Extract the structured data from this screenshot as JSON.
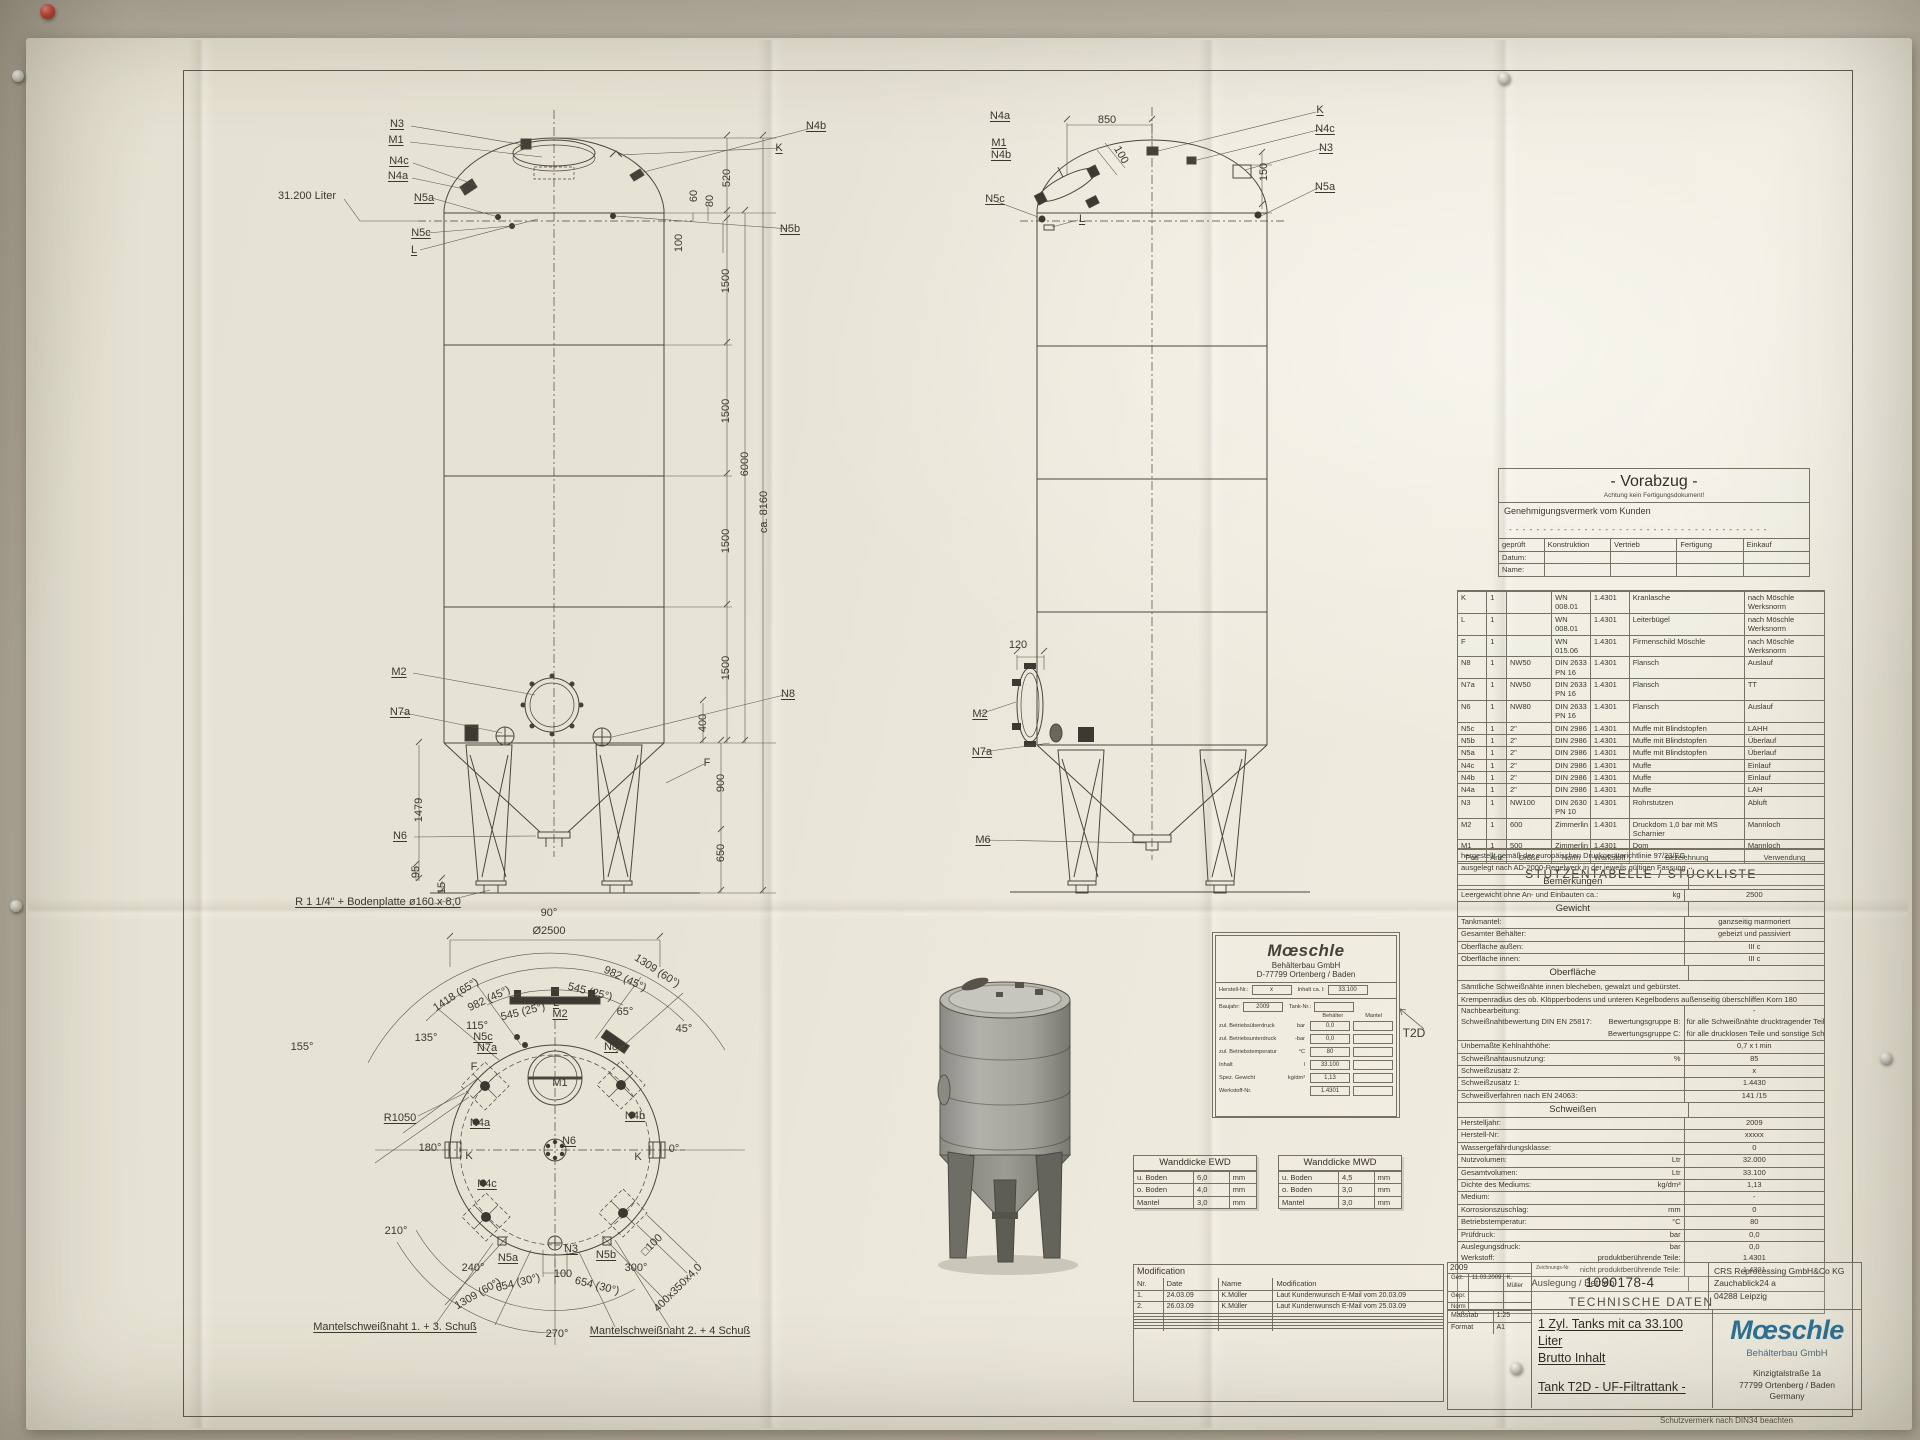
{
  "vorabzug": {
    "title": "- Vorabzug -",
    "subtitle": "Achtung kein Fertigungsdokument!",
    "approval": "Genehmigungsvermerk vom Kunden",
    "dashes": "- - - - - - - - - - - - - - - - - - - - - - - - - - - - - - - - - - - - - -",
    "headers": [
      "geprüft",
      "Konstruktion",
      "Vertrieb",
      "Fertigung",
      "Einkauf"
    ],
    "rows": [
      [
        "Datum:",
        "",
        "",
        "",
        ""
      ],
      [
        "Name:",
        "",
        "",
        "",
        ""
      ]
    ]
  },
  "stueckliste": {
    "title": "STUTZENTABELLE / STÜCKLISTE",
    "headers": [
      "Pos",
      "Anz",
      "Größe",
      "Norm",
      "Werkstoff",
      "Bezeichnung",
      "Verwendung"
    ],
    "rows": [
      [
        "K",
        "1",
        "",
        "WN 008.01",
        "1.4301",
        "Kranlasche",
        "nach Möschle Werksnorm"
      ],
      [
        "L",
        "1",
        "",
        "WN 008.01",
        "1.4301",
        "Leiterbügel",
        "nach Möschle Werksnorm"
      ],
      [
        "F",
        "1",
        "",
        "WN 015.06",
        "1.4301",
        "Firmenschild Möschle",
        "nach Möschle Werksnorm"
      ],
      [
        "N8",
        "1",
        "NW50",
        "DIN 2633 PN 16",
        "1.4301",
        "Flansch",
        "Auslauf"
      ],
      [
        "N7a",
        "1",
        "NW50",
        "DIN 2633 PN 16",
        "1.4301",
        "Flansch",
        "TT"
      ],
      [
        "N6",
        "1",
        "NW80",
        "DIN 2633 PN 16",
        "1.4301",
        "Flansch",
        "Auslauf"
      ],
      [
        "N5c",
        "1",
        "2\"",
        "DIN 2986",
        "1.4301",
        "Muffe mit Blindstopfen",
        "LAHH"
      ],
      [
        "N5b",
        "1",
        "2\"",
        "DIN 2986",
        "1.4301",
        "Muffe mit Blindstopfen",
        "Überlauf"
      ],
      [
        "N5a",
        "1",
        "2\"",
        "DIN 2986",
        "1.4301",
        "Muffe mit Blindstopfen",
        "Überlauf"
      ],
      [
        "N4c",
        "1",
        "2\"",
        "DIN 2986",
        "1.4301",
        "Muffe",
        "Einlauf"
      ],
      [
        "N4b",
        "1",
        "2\"",
        "DIN 2986",
        "1.4301",
        "Muffe",
        "Einlauf"
      ],
      [
        "N4a",
        "1",
        "2\"",
        "DIN 2986",
        "1.4301",
        "Muffe",
        "LAH"
      ],
      [
        "N3",
        "1",
        "NW100",
        "DIN 2630 PN 10",
        "1.4301",
        "Rohrstutzen",
        "Abluft"
      ],
      [
        "M2",
        "1",
        "600",
        "Zimmerlin",
        "1.4301",
        "Druckdom 1,0 bar mit MS Scharnier",
        "Mannloch"
      ],
      [
        "M1",
        "1",
        "500",
        "Zimmerlin",
        "1.4301",
        "Dom",
        "Mannloch"
      ]
    ]
  },
  "tech": {
    "title": "TECHNISCHE DATEN",
    "rows": [
      {
        "t": "text",
        "a": "hergestellt gemäß der europäischen Druckgeräterichtlinie 97/23/EG."
      },
      {
        "t": "text",
        "a": "ausgelegt nach AD-2000-Regelwerk in der jeweils gültigen Fassung"
      },
      {
        "t": "sec",
        "a": "Bemerkungen"
      },
      {
        "t": "kvu",
        "a": "Leergewicht ohne An- und Einbauten ca.:",
        "u": "kg",
        "v": "2500"
      },
      {
        "t": "sec",
        "a": "Gewicht"
      },
      {
        "t": "kv",
        "a": "Tankmantel:",
        "v": "ganzseitig marmoriert"
      },
      {
        "t": "kv",
        "a": "Gesamter Behälter:",
        "v": "gebeizt und passiviert"
      },
      {
        "t": "kv",
        "a": "Oberfläche außen:",
        "v": "III c"
      },
      {
        "t": "kv",
        "a": "Oberfläche innen:",
        "v": "III c"
      },
      {
        "t": "sec",
        "a": "Oberfläche"
      },
      {
        "t": "text",
        "a": "Sämtliche Schweißnähte innen blecheben, gewalzt und gebürstet."
      },
      {
        "t": "text",
        "a": "Krempenradius des ob. Klöpperbodens und unteren Kegelbodens außenseitig überschliffen Korn 180"
      },
      {
        "t": "kv",
        "a": "Nachbearbeitung:",
        "v": "-"
      },
      {
        "t": "kv2",
        "a": "Schweißnahtbewertung DIN EN 25817:",
        "s": "Bewertungsgruppe B:",
        "v": "für alle Schweißnähte drucktragender Teile",
        "s2": "Bewertungsgruppe C:",
        "v2": "für alle drucklosen Teile und sonstige Schweißnähte"
      },
      {
        "t": "kv",
        "a": "Unbemaßte Kehlnahthöhe:",
        "v": "0,7 x t min"
      },
      {
        "t": "kvu",
        "a": "Schweißnahtausnutzung:",
        "u": "%",
        "v": "85"
      },
      {
        "t": "kv",
        "a": "Schweißzusatz 2:",
        "v": "x"
      },
      {
        "t": "kv",
        "a": "Schweißzusatz 1:",
        "v": "1.4430"
      },
      {
        "t": "kv",
        "a": "Schweißverfahren nach EN 24063:",
        "v": "141 /15"
      },
      {
        "t": "sec",
        "a": "Schweißen"
      },
      {
        "t": "kv",
        "a": "Herstelljahr:",
        "v": "2009"
      },
      {
        "t": "kv",
        "a": "Herstell-Nr:",
        "v": "xxxxx"
      },
      {
        "t": "kv",
        "a": "Wassergefährdungsklasse:",
        "v": "0"
      },
      {
        "t": "kvu",
        "a": "Nutzvolumen:",
        "u": "Ltr",
        "v": "32.000"
      },
      {
        "t": "kvu",
        "a": "Gesamtvolumen:",
        "u": "Ltr",
        "v": "33.100"
      },
      {
        "t": "kvu",
        "a": "Dichte des Mediums:",
        "u": "kg/dm³",
        "v": "1,13"
      },
      {
        "t": "kv",
        "a": "Medium:",
        "v": "-"
      },
      {
        "t": "kvu",
        "a": "Korrosionszuschlag:",
        "u": "mm",
        "v": "0"
      },
      {
        "t": "kvu",
        "a": "Betriebstemperatur:",
        "u": "°C",
        "v": "80"
      },
      {
        "t": "kvu",
        "a": "Prüfdruck:",
        "u": "bar",
        "v": "0,0"
      },
      {
        "t": "kvu",
        "a": "Auslegungsdruck:",
        "u": "bar",
        "v": "0,0"
      },
      {
        "t": "kv2",
        "a": "Werkstoff:",
        "s": "produktberührende Teile:",
        "v": "1.4301",
        "s2": "nicht produktberührende Teile:",
        "v2": "1.4301"
      },
      {
        "t": "sec",
        "a": "Auslegung / Betrieb"
      }
    ]
  },
  "nameplate": {
    "brand": "Mœschle",
    "sub": "Behälterbau GmbH",
    "city": "D-77799 Ortenberg / Baden",
    "r1l": "Herstell-Nr.:",
    "r1v": "x",
    "r1l2": "Inhalt ca. l:",
    "r1v2": "33.100",
    "r2l": "Baujahr:",
    "r2v": "2009",
    "r2l2": "Tank-Nr.:",
    "r2v2": "",
    "colh1": "Behälter",
    "colh2": "Mantel",
    "rows": [
      {
        "l": "zul. Betriebsüberdruck",
        "u": "bar",
        "v": "0,0"
      },
      {
        "l": "zul. Betriebsunterdruck",
        "u": "-bar",
        "v": "0,0"
      },
      {
        "l": "zul. Betriebstemperatur",
        "u": "°C",
        "v": "80"
      },
      {
        "l": "Inhalt",
        "u": "l",
        "v": "33.100"
      },
      {
        "l": "Spez. Gewicht",
        "u": "kg/dm³",
        "v": "1,13"
      },
      {
        "l": "Werkstoff-Nr.",
        "u": "",
        "v": "1.4301"
      }
    ],
    "callout": "T2D"
  },
  "wanddicke_ewd": {
    "title": "Wanddicke EWD",
    "rows": [
      [
        "u. Boden",
        "6,0",
        "mm"
      ],
      [
        "o. Boden",
        "4,0",
        "mm"
      ],
      [
        "Mantel",
        "3,0",
        "mm"
      ]
    ]
  },
  "wanddicke_mwd": {
    "title": "Wanddicke MWD",
    "rows": [
      [
        "u. Boden",
        "4,5",
        "mm"
      ],
      [
        "o. Boden",
        "3,0",
        "mm"
      ],
      [
        "Mantel",
        "3,0",
        "mm"
      ]
    ]
  },
  "modification": {
    "title": "Modification",
    "headers": [
      "Nr.",
      "Date",
      "Name",
      "Modification"
    ],
    "rows": [
      [
        "1.",
        "24.03.09",
        "K.Müller",
        "Laut Kundenwunsch E-Mail vom 20.03.09"
      ],
      [
        "2.",
        "26.03.09",
        "K.Müller",
        "Laut Kundenwunsch E-Mail vom 25.03.09"
      ],
      [
        "",
        "",
        "",
        ""
      ],
      [
        "",
        "",
        "",
        ""
      ],
      [
        "",
        "",
        "",
        ""
      ],
      [
        "",
        "",
        "",
        ""
      ],
      [
        "",
        "",
        "",
        ""
      ],
      [
        "",
        "",
        "",
        ""
      ]
    ]
  },
  "titleblock": {
    "year": "2009",
    "info_rows": [
      [
        "Gez.",
        "11.03.2009",
        "K. Müller"
      ],
      [
        "Gepr.",
        "",
        ""
      ],
      [
        "Norm",
        "",
        ""
      ]
    ],
    "scale_rows": [
      [
        "Maßstab",
        "1:25"
      ],
      [
        "Format",
        "A1"
      ]
    ],
    "drawing_no_label": "Zeichnungs-Nr.",
    "drawing_no": "1090178-4",
    "customer": [
      "CRS Reprocessing GmbH&Co KG",
      "Zauchablick24 a",
      "04288 Leipzig"
    ],
    "title_line1": "1 Zyl. Tanks mit ca 33.100 Liter",
    "title_line2": "Brutto Inhalt",
    "subtitle": "Tank T2D - UF-Filtrattank -",
    "brand": "Mœschle",
    "brand_sub": "Behälterbau GmbH",
    "brand_addr": [
      "Kinzigtalstraße 1a",
      "77799 Ortenberg / Baden",
      "Germany"
    ],
    "footer": "Schutzvermerk nach DIN34 beachten"
  },
  "callouts": {
    "front": [
      {
        "t": "N3",
        "x": 397,
        "y": 124,
        "u": 1
      },
      {
        "t": "M1",
        "x": 396,
        "y": 140,
        "u": 1
      },
      {
        "t": "N4c",
        "x": 399,
        "y": 161,
        "u": 1
      },
      {
        "t": "N4a",
        "x": 398,
        "y": 176,
        "u": 1
      },
      {
        "t": "31.200 Liter",
        "x": 307,
        "y": 196
      },
      {
        "t": "N5a",
        "x": 424,
        "y": 198,
        "u": 1
      },
      {
        "t": "N5c",
        "x": 421,
        "y": 233,
        "u": 1
      },
      {
        "t": "L",
        "x": 414,
        "y": 250,
        "u": 1
      },
      {
        "t": "N4b",
        "x": 816,
        "y": 126,
        "u": 1
      },
      {
        "t": "K",
        "x": 779,
        "y": 148,
        "u": 1
      },
      {
        "t": "N5b",
        "x": 790,
        "y": 229,
        "u": 1
      },
      {
        "t": "520",
        "x": 727,
        "y": 178,
        "r": -90
      },
      {
        "t": "60",
        "x": 694,
        "y": 196,
        "r": -90
      },
      {
        "t": "80",
        "x": 710,
        "y": 201,
        "r": -90
      },
      {
        "t": "100",
        "x": 679,
        "y": 243,
        "r": -90
      },
      {
        "t": "1500",
        "x": 726,
        "y": 281,
        "r": -90
      },
      {
        "t": "1500",
        "x": 726,
        "y": 411,
        "r": -90
      },
      {
        "t": "1500",
        "x": 726,
        "y": 541,
        "r": -90
      },
      {
        "t": "1500",
        "x": 726,
        "y": 668,
        "r": -90
      },
      {
        "t": "6000",
        "x": 745,
        "y": 464,
        "r": -90
      },
      {
        "t": "ca. 8160",
        "x": 764,
        "y": 512,
        "r": -90
      },
      {
        "t": "M2",
        "x": 399,
        "y": 672,
        "u": 1
      },
      {
        "t": "N7a",
        "x": 400,
        "y": 712,
        "u": 1
      },
      {
        "t": "400",
        "x": 703,
        "y": 723,
        "r": -90
      },
      {
        "t": "N8",
        "x": 788,
        "y": 694,
        "u": 1
      },
      {
        "t": "F",
        "x": 707,
        "y": 763
      },
      {
        "t": "900",
        "x": 721,
        "y": 783,
        "r": -90
      },
      {
        "t": "650",
        "x": 721,
        "y": 853,
        "r": -90
      },
      {
        "t": "1479",
        "x": 419,
        "y": 810,
        "r": -90
      },
      {
        "t": "N6",
        "x": 400,
        "y": 836,
        "u": 1
      },
      {
        "t": "95",
        "x": 416,
        "y": 872,
        "r": -90
      },
      {
        "t": "15",
        "x": 442,
        "y": 888,
        "r": -90
      },
      {
        "t": "R 1 1/4\" + Bodenplatte ø160 x 8,0",
        "x": 378,
        "y": 902,
        "u": 1
      },
      {
        "t": "90°",
        "x": 549,
        "y": 913
      },
      {
        "t": "Ø2500",
        "x": 549,
        "y": 931
      }
    ],
    "side": [
      {
        "t": "N4a",
        "x": 1000,
        "y": 116,
        "u": 1
      },
      {
        "t": "850",
        "x": 1107,
        "y": 120
      },
      {
        "t": "M1",
        "x": 999,
        "y": 143,
        "u": 1
      },
      {
        "t": "N4b",
        "x": 1001,
        "y": 155,
        "u": 1
      },
      {
        "t": "100",
        "x": 1121,
        "y": 155,
        "r": 60
      },
      {
        "t": "K",
        "x": 1320,
        "y": 110,
        "u": 1
      },
      {
        "t": "N4c",
        "x": 1325,
        "y": 129,
        "u": 1
      },
      {
        "t": "N3",
        "x": 1326,
        "y": 148,
        "u": 1
      },
      {
        "t": "150",
        "x": 1264,
        "y": 172,
        "r": -90
      },
      {
        "t": "N5a",
        "x": 1325,
        "y": 187,
        "u": 1
      },
      {
        "t": "N5c",
        "x": 995,
        "y": 199,
        "u": 1
      },
      {
        "t": "L",
        "x": 1082,
        "y": 219,
        "u": 1
      },
      {
        "t": "120",
        "x": 1018,
        "y": 645
      },
      {
        "t": "M2",
        "x": 980,
        "y": 714,
        "u": 1
      },
      {
        "t": "N7a",
        "x": 982,
        "y": 752,
        "u": 1
      },
      {
        "t": "M6",
        "x": 983,
        "y": 840,
        "u": 1
      }
    ],
    "topview": [
      {
        "t": "1418 (65°)",
        "x": 456,
        "y": 995,
        "r": -33
      },
      {
        "t": "982 (45°)",
        "x": 489,
        "y": 999,
        "r": -25
      },
      {
        "t": "545 (25°)",
        "x": 523,
        "y": 1012,
        "r": -14
      },
      {
        "t": "L",
        "x": 556,
        "y": 1003,
        "u": 1
      },
      {
        "t": "M2",
        "x": 560,
        "y": 1014,
        "u": 1
      },
      {
        "t": "545 (25°)",
        "x": 590,
        "y": 992,
        "r": 14
      },
      {
        "t": "982 (45°)",
        "x": 625,
        "y": 979,
        "r": 25
      },
      {
        "t": "1309 (60°)",
        "x": 657,
        "y": 971,
        "r": 33
      },
      {
        "t": "65°",
        "x": 625,
        "y": 1012
      },
      {
        "t": "45°",
        "x": 684,
        "y": 1029
      },
      {
        "t": "135°",
        "x": 426,
        "y": 1038
      },
      {
        "t": "115°",
        "x": 477,
        "y": 1026
      },
      {
        "t": "155°",
        "x": 302,
        "y": 1047
      },
      {
        "t": "N5c",
        "x": 483,
        "y": 1037,
        "u": 1
      },
      {
        "t": "N7a",
        "x": 487,
        "y": 1048,
        "u": 1
      },
      {
        "t": "F",
        "x": 474,
        "y": 1067
      },
      {
        "t": "N8",
        "x": 611,
        "y": 1047,
        "u": 1
      },
      {
        "t": "M1",
        "x": 560,
        "y": 1083
      },
      {
        "t": "R1050",
        "x": 400,
        "y": 1118,
        "u": 1
      },
      {
        "t": "N4a",
        "x": 480,
        "y": 1123,
        "u": 1
      },
      {
        "t": "N4b",
        "x": 635,
        "y": 1116,
        "u": 1
      },
      {
        "t": "180°",
        "x": 430,
        "y": 1148
      },
      {
        "t": "0°",
        "x": 674,
        "y": 1149
      },
      {
        "t": "K",
        "x": 469,
        "y": 1156
      },
      {
        "t": "K",
        "x": 638,
        "y": 1157
      },
      {
        "t": "N6",
        "x": 569,
        "y": 1141,
        "u": 1
      },
      {
        "t": "N4c",
        "x": 487,
        "y": 1184,
        "u": 1
      },
      {
        "t": "210°",
        "x": 396,
        "y": 1231
      },
      {
        "t": "N5a",
        "x": 508,
        "y": 1258,
        "u": 1
      },
      {
        "t": "240°",
        "x": 473,
        "y": 1268
      },
      {
        "t": "654 (30°)",
        "x": 518,
        "y": 1283,
        "r": -14
      },
      {
        "t": "1309 (60°)",
        "x": 478,
        "y": 1294,
        "r": -30
      },
      {
        "t": "100",
        "x": 563,
        "y": 1274
      },
      {
        "t": "N3",
        "x": 571,
        "y": 1249,
        "u": 1
      },
      {
        "t": "N5b",
        "x": 606,
        "y": 1255,
        "u": 1
      },
      {
        "t": "300°",
        "x": 636,
        "y": 1268
      },
      {
        "t": "654 (30°)",
        "x": 597,
        "y": 1286,
        "r": 14
      },
      {
        "t": "□100",
        "x": 652,
        "y": 1245,
        "r": -45
      },
      {
        "t": "400x350x4,0",
        "x": 678,
        "y": 1288,
        "r": -45
      },
      {
        "t": "270°",
        "x": 557,
        "y": 1334
      },
      {
        "t": "Mantelschweißnaht 1. + 3. Schuß",
        "x": 395,
        "y": 1327,
        "u": 1
      },
      {
        "t": "Mantelschweißnaht 2. + 4 Schuß",
        "x": 670,
        "y": 1331,
        "u": 1
      }
    ]
  }
}
